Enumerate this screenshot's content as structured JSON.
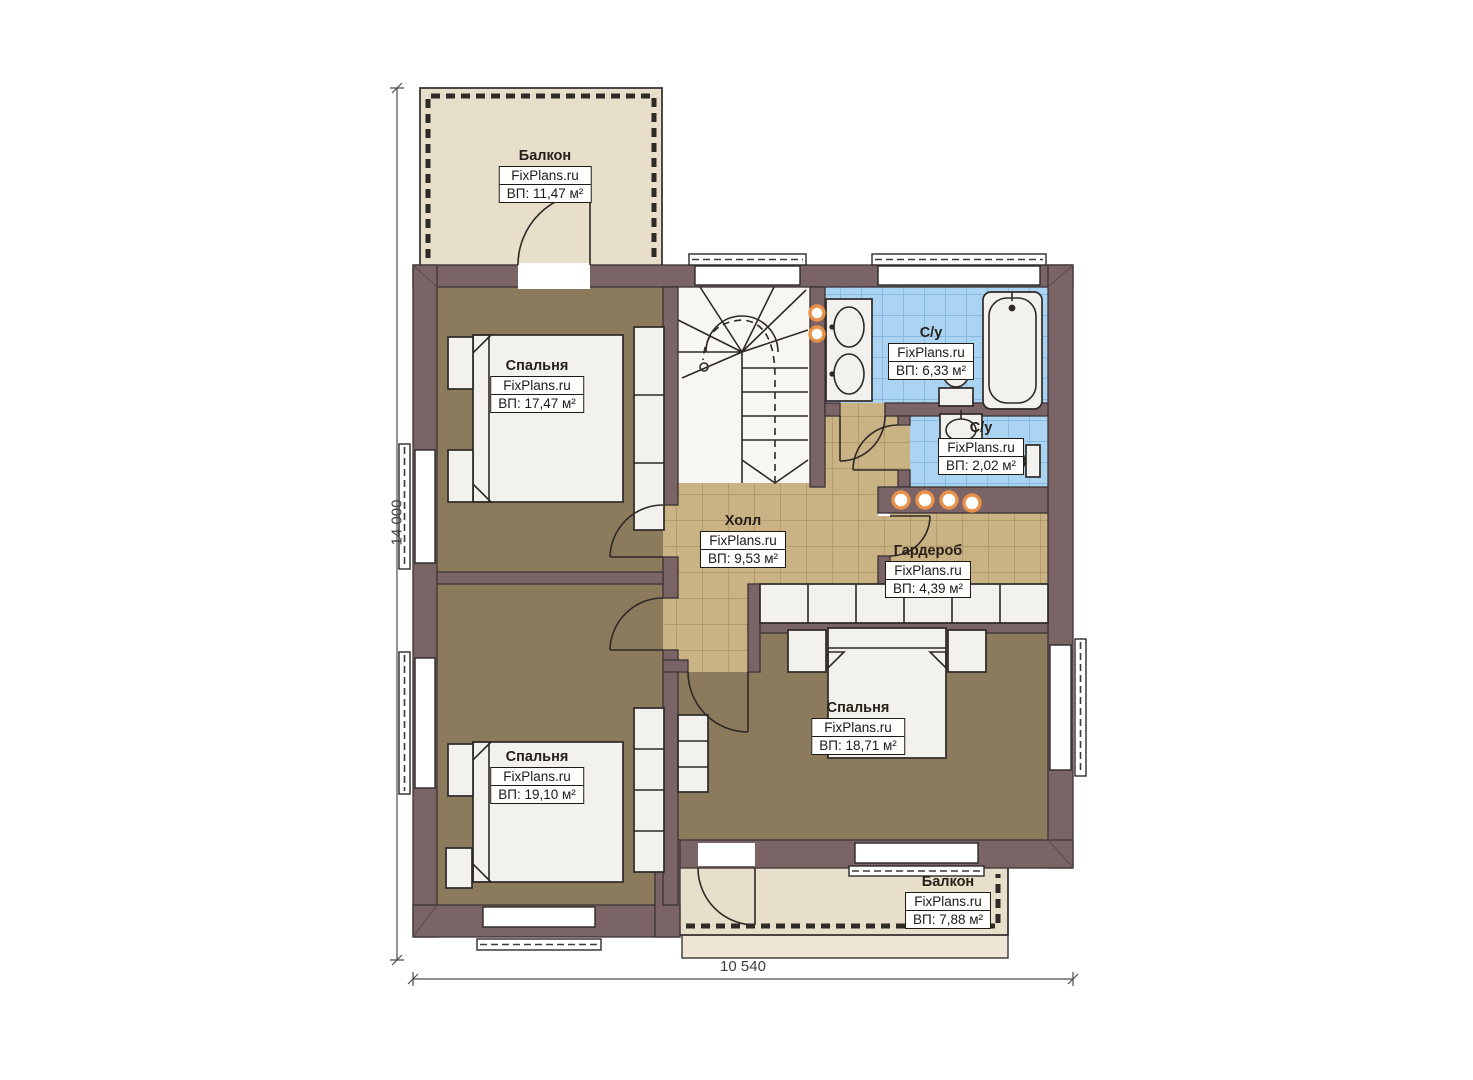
{
  "dimensions": {
    "left": "14 000",
    "bottom": "10 540"
  },
  "rooms": [
    {
      "name": "Балкон",
      "brand": "FixPlans.ru",
      "area": "ВП: 11,47 м²"
    },
    {
      "name": "Спальня",
      "brand": "FixPlans.ru",
      "area": "ВП: 17,47 м²"
    },
    {
      "name": "С/у",
      "brand": "FixPlans.ru",
      "area": "ВП: 6,33 м²"
    },
    {
      "name": "С/у",
      "brand": "FixPlans.ru",
      "area": "ВП: 2,02 м²"
    },
    {
      "name": "Холл",
      "brand": "FixPlans.ru",
      "area": "ВП: 9,53 м²"
    },
    {
      "name": "Гардероб",
      "brand": "FixPlans.ru",
      "area": "ВП: 4,39 м²"
    },
    {
      "name": "Спальня",
      "brand": "FixPlans.ru",
      "area": "ВП: 19,10 м²"
    },
    {
      "name": "Спальня",
      "brand": "FixPlans.ru",
      "area": "ВП: 18,71 м²"
    },
    {
      "name": "Балкон",
      "brand": "FixPlans.ru",
      "area": "ВП: 7,88 м²"
    }
  ],
  "colors": {
    "wall": "#7b6465",
    "wall-outline": "#3c3335",
    "floor-bedroom": "#8c7a5d",
    "floor-tile": "#c9b283",
    "tile-line": "#a68c5c",
    "floor-bath": "#aad4f1",
    "bath-line": "#74abd8",
    "balcony": "#e7dfca",
    "fixture": "#f2f1ed",
    "line": "#2e2927",
    "light-accent": "#e8914a",
    "dim-color": "#4c4c4c"
  }
}
